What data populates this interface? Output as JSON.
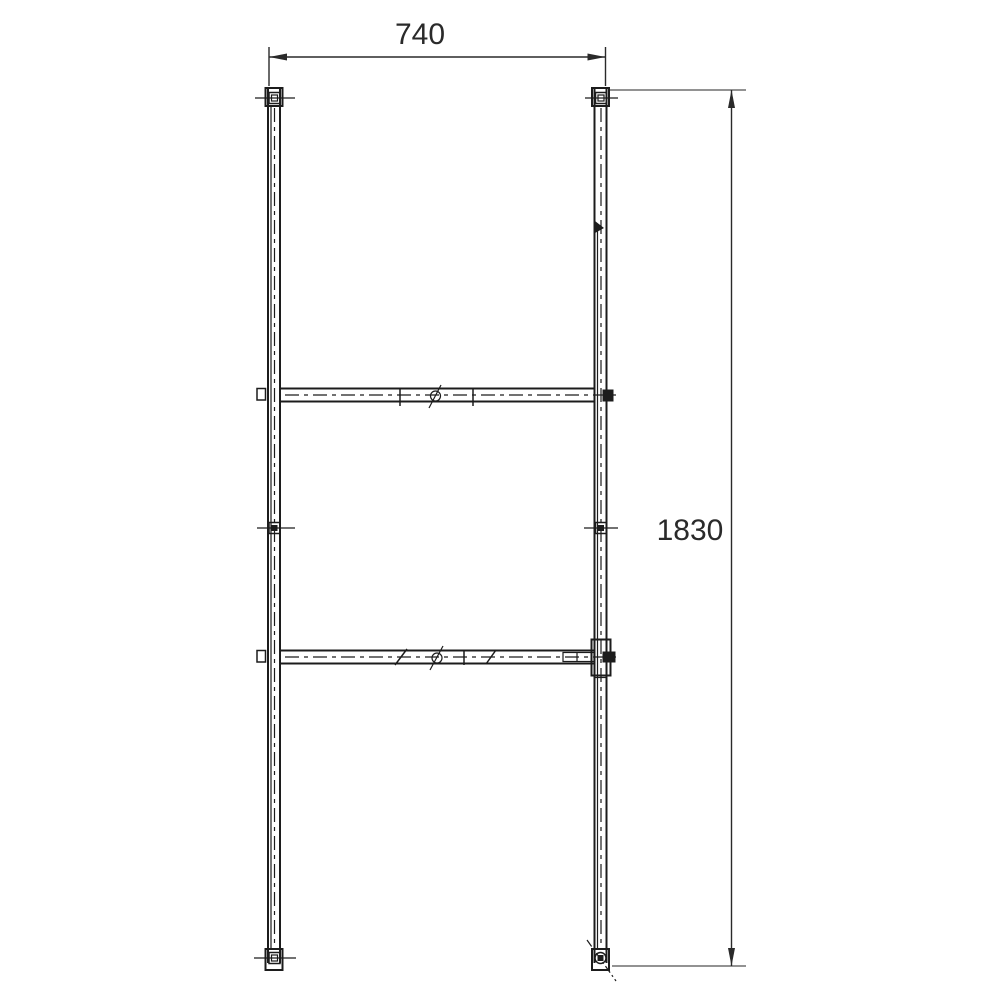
{
  "drawing": {
    "type": "technical-line-drawing",
    "colors": {
      "background": "#ffffff",
      "line": "#1c1c1c",
      "dimension": "#2a2a2a",
      "extension": "#6e6e6e"
    },
    "dimensions": {
      "width": {
        "label": "740"
      },
      "height": {
        "label": "1830"
      }
    },
    "icons": {
      "dimension_arrow": "filled-triangle",
      "bolt": "square-in-square",
      "hole": "circle-with-slash"
    }
  }
}
